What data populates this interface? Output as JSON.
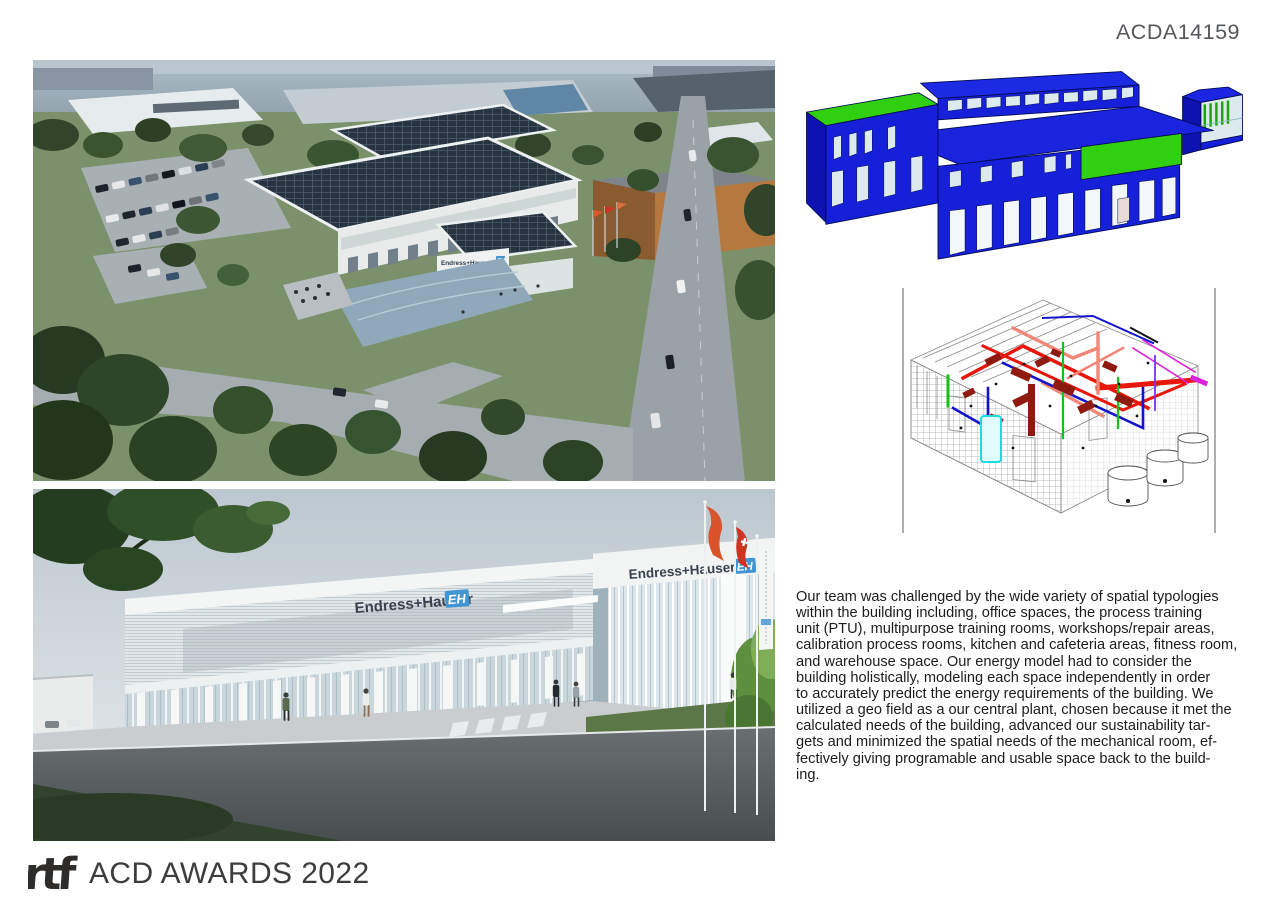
{
  "page": {
    "id": "ACDA14159"
  },
  "brand": {
    "name": "Endress+Hauser",
    "monogram": "EH",
    "logo_color": "#4095d2"
  },
  "figures": {
    "aerial": {
      "label": "aerial-campus-rendering"
    },
    "street": {
      "label": "street-entrance-rendering"
    },
    "energy_model": {
      "label": "energy-model-massing",
      "volume_color": "#1720d9",
      "accent_color": "#30d011",
      "window_color": "#dceaed"
    },
    "mep": {
      "label": "mechanical-systems-axonometric",
      "pipe_colors": {
        "red": "#e8170b",
        "dark_red": "#8e1a10",
        "pink": "#f08878",
        "blue": "#1414cc",
        "green": "#15c115",
        "magenta": "#dd22dd",
        "cyan": "#19dede"
      }
    }
  },
  "description": {
    "lines": [
      "Our team was challenged by the wide variety of spatial typologies",
      "within the building including, office spaces, the process training",
      "unit (PTU), multipurpose training rooms, workshops/repair areas,",
      "calibration process rooms, kitchen and cafeteria areas, fitness room,",
      "and warehouse space. Our energy model had to consider the",
      "building holistically, modeling each space independently in order",
      "to accurately predict the energy requirements of the building. We",
      "utilized a geo field as a our central plant, chosen because it met the",
      "calculated needs of the building, advanced our sustainability tar-",
      "gets and minimized the spatial needs of the mechanical room, ef-",
      "fectively giving programable and usable space back to the build-",
      "ing."
    ]
  },
  "footer": {
    "logo": "rtf",
    "title": "ACD AWARDS 2022"
  }
}
